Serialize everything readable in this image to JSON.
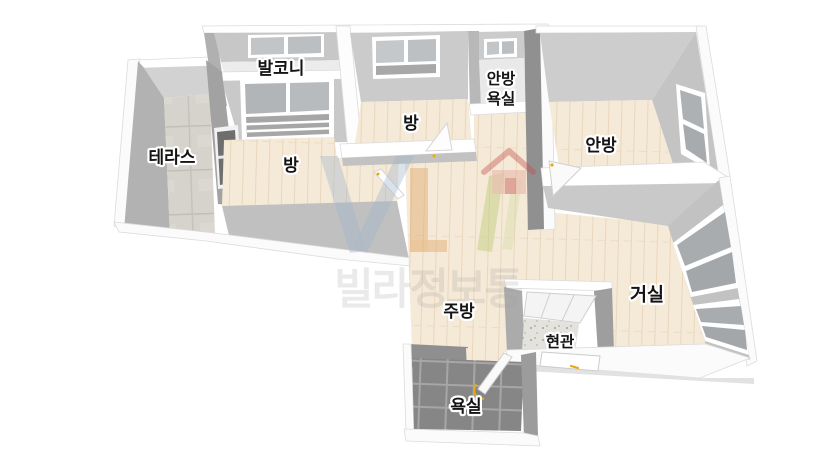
{
  "page": {
    "background": "#ffffff",
    "kind": "3d-isometric-floorplan-render"
  },
  "floorplan": {
    "rooms": {
      "balcony": "발코니",
      "terrace": "테라스",
      "room_left": "방",
      "room_top": "방",
      "master_bath_line1": "안방",
      "master_bath_line2": "욕실",
      "master_bedroom": "안방",
      "living_room": "거실",
      "kitchen": "주방",
      "entrance": "현관",
      "bathroom": "욕실"
    },
    "watermark": {
      "text": "빌라정보통",
      "logo_icon": "villa-house-logo-icon",
      "colors": {
        "v_blue": "#9db2c9",
        "l_orange": "#dfa35e",
        "slash_green": "#b5c86e",
        "house_red": "#c0504a",
        "text_gray": "#9e9e9e"
      }
    },
    "palette": {
      "wall_top": "#ffffff",
      "wall_light": "#cbcbcb",
      "wall_medium": "#b2b2b2",
      "wall_dark": "#8e8e8e",
      "wood_floor": "#f5e9d7",
      "terrace_stone": "#d6d3cc",
      "bathroom_tile": "#868686",
      "entry_tile": "#e4e2dd",
      "window_glass": "#b4b7b9",
      "door_handle_yellow": "#e8a912"
    }
  }
}
